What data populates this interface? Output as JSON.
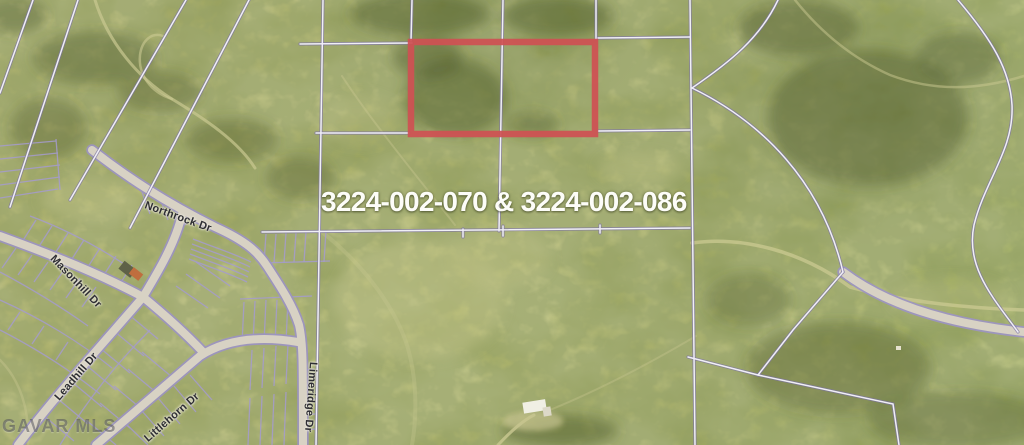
{
  "map_labels": {
    "parcel_ids": "3224-002-070 & 3224-002-086",
    "watermark": "GAVAR MLS"
  },
  "streets": [
    {
      "name": "Northrock Dr"
    },
    {
      "name": "Masonhill Dr"
    },
    {
      "name": "Leadhill Dr"
    },
    {
      "name": "Littlehorn Dr"
    },
    {
      "name": "Limeridge Dr"
    }
  ],
  "colors": {
    "highlight-red": "#cf5153",
    "parcel-line": "#f0eff6",
    "parcel-line-edge": "#9c93c4",
    "road-fill": "#d8d2c4",
    "terrain-base": "#9ea455",
    "label-text": "#2e2e33",
    "parcel-label-text": "#fdfdf8"
  }
}
